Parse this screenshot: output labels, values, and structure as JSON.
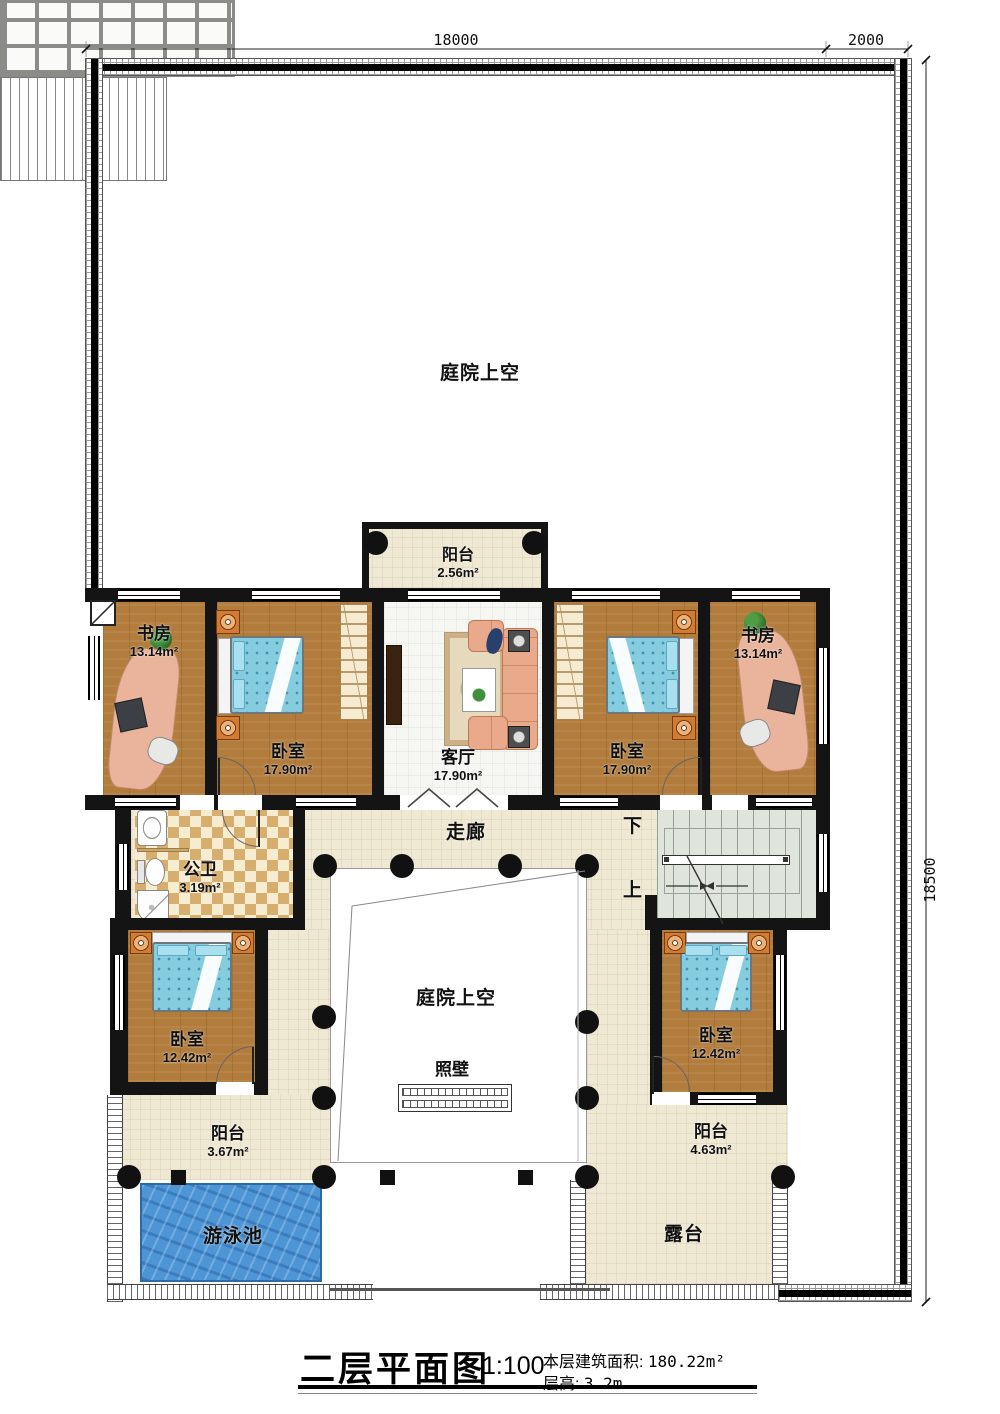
{
  "dimensions": {
    "top": "18000",
    "top_right": "2000",
    "right": "18500"
  },
  "rooms": {
    "courtyard_top": "庭院上空",
    "balcony_top": {
      "name": "阳台",
      "area": "2.56m²"
    },
    "study_nw": {
      "name": "书房",
      "area": "13.14m²"
    },
    "bedroom_nw": {
      "name": "卧室",
      "area": "17.90m²"
    },
    "living": {
      "name": "客厅",
      "area": "17.90m²"
    },
    "bedroom_ne": {
      "name": "卧室",
      "area": "17.90m²"
    },
    "study_ne": {
      "name": "书房",
      "area": "13.14m²"
    },
    "corridor": "走廊",
    "bathroom": {
      "name": "公卫",
      "area": "3.19m²"
    },
    "stair_down": "下",
    "stair_up": "上",
    "bedroom_sw": {
      "name": "卧室",
      "area": "12.42m²"
    },
    "bedroom_se": {
      "name": "卧室",
      "area": "12.42m²"
    },
    "courtyard_center": "庭院上空",
    "screen_wall": "照壁",
    "balcony_sw": {
      "name": "阳台",
      "area": "3.67m²"
    },
    "balcony_se": {
      "name": "阳台",
      "area": "4.63m²"
    },
    "pool": "游泳池",
    "terrace": "露台"
  },
  "title_block": {
    "title": "二层平面图",
    "scale": "1:100",
    "area_label": "本层建筑面积:",
    "area_value": "180.22m²",
    "floor_height_label": "层高:",
    "floor_height_value": "3.2m"
  },
  "colors": {
    "wood": "#b27c3c",
    "tile": "#efe9d3",
    "pool_water": "#4e95d5",
    "wall": "#141414",
    "stair_floor": "#dfe5dd",
    "checker": "#d8ae6e"
  }
}
